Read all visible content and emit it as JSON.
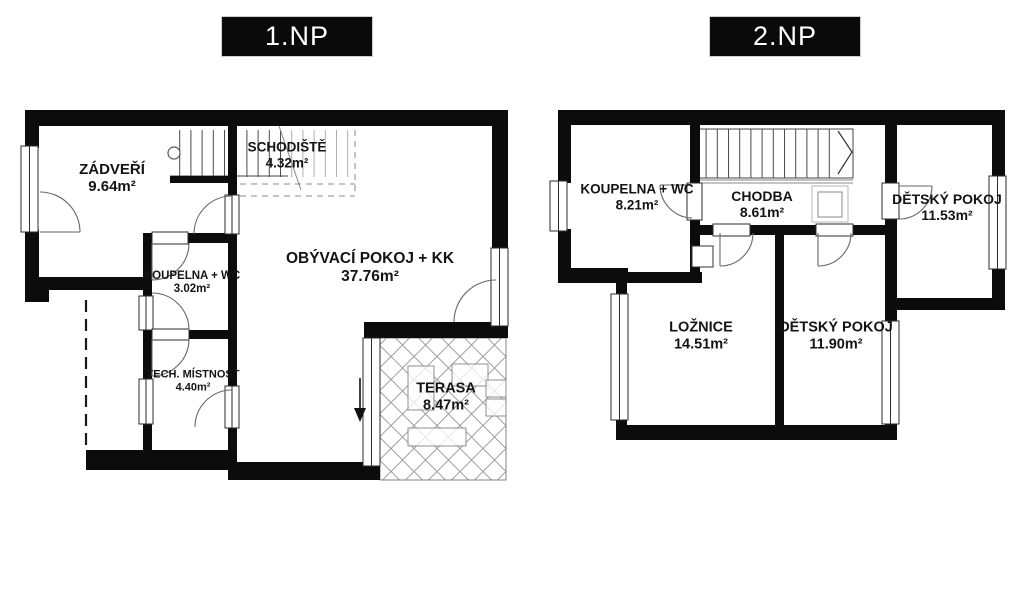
{
  "colors": {
    "wall": "#0c0c0c",
    "background": "#ffffff",
    "title_bg": "#0a0a0a",
    "title_text": "#ffffff",
    "hatch_line": "#9a9a9a"
  },
  "floors": [
    {
      "title": "1.NP",
      "rooms": [
        {
          "name": "ZÁDVEŘÍ",
          "area": "9.64m²"
        },
        {
          "name": "SCHODIŠTĚ",
          "area": "4.32m²"
        },
        {
          "name": "OBÝVACÍ POKOJ + KK",
          "area": "37.76m²"
        },
        {
          "name": "KOUPELNA + WC",
          "area": "3.02m²"
        },
        {
          "name": "TECH. MÍSTNOST",
          "area": "4.40m²"
        },
        {
          "name": "TERASA",
          "area": "8.47m²"
        }
      ]
    },
    {
      "title": "2.NP",
      "rooms": [
        {
          "name": "KOUPELNA + WC",
          "area": "8.21m²"
        },
        {
          "name": "CHODBA",
          "area": "8.61m²"
        },
        {
          "name": "DĚTSKÝ POKOJ",
          "area": "11.53m²"
        },
        {
          "name": "LOŽNICE",
          "area": "14.51m²"
        },
        {
          "name": "DĚTSKÝ POKOJ",
          "area": "11.90m²"
        }
      ]
    }
  ]
}
